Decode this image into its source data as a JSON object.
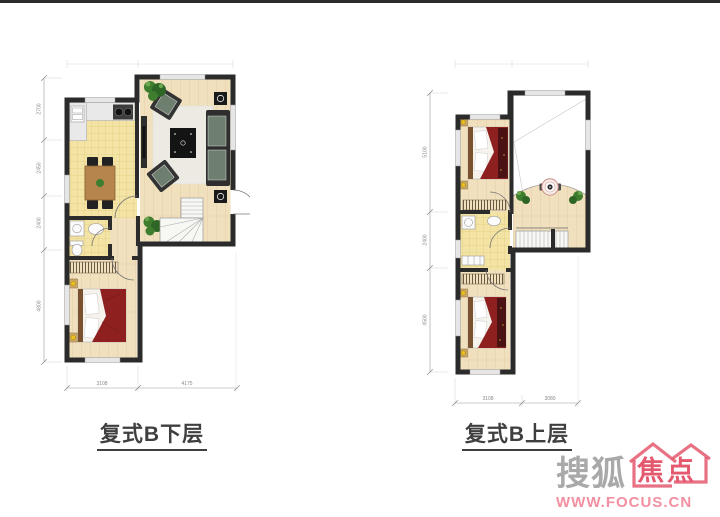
{
  "page": {
    "background": "#ffffff",
    "top_border_color": "#1f1f1f"
  },
  "plans": {
    "lower": {
      "title": "复式B下层",
      "dims_bottom": [
        "3108",
        "4175"
      ],
      "dims_left": [
        "2700",
        "2450",
        "2400",
        "4800"
      ]
    },
    "upper": {
      "title": "复式B上层",
      "dims_bottom": [
        "3108",
        "3080"
      ],
      "dims_left": [
        "5100",
        "2400",
        "4500"
      ]
    }
  },
  "watermark": {
    "brand_gray": "搜狐",
    "brand_red": "焦点",
    "url": "WWW.FOCUS.CN",
    "gray_color": "#a9a9a9",
    "red_color": "#e4596e",
    "url_color": "#f28fa0"
  },
  "colors": {
    "wall": "#2b2b2b",
    "wood": "#f1e0bd",
    "wood_line": "#dcc49a",
    "tile": "#f3e3a4",
    "tile_line": "#d9c070",
    "blanket": "#8e2020",
    "blanket_dark": "#4a1212",
    "plant": "#3f7d2f",
    "plant_dark": "#2e6626",
    "plant_light": "#6aa84f",
    "dim": "#9a9a9a",
    "dim_text": "#8a8a8a",
    "label": "#3f3f3f",
    "furniture_dark": "#2e2e2e",
    "cushion": "#6f7f6f",
    "counter": "#e9e9e9",
    "table_wood": "#b5854d",
    "headboard": "#7a5230",
    "nightstand": "#c9a86a",
    "lamp": "#e8c020",
    "window": "#e6e6e6",
    "stair": "#f7f7f4",
    "mattress": "#f6f3ec",
    "rug": "#eceae2"
  }
}
